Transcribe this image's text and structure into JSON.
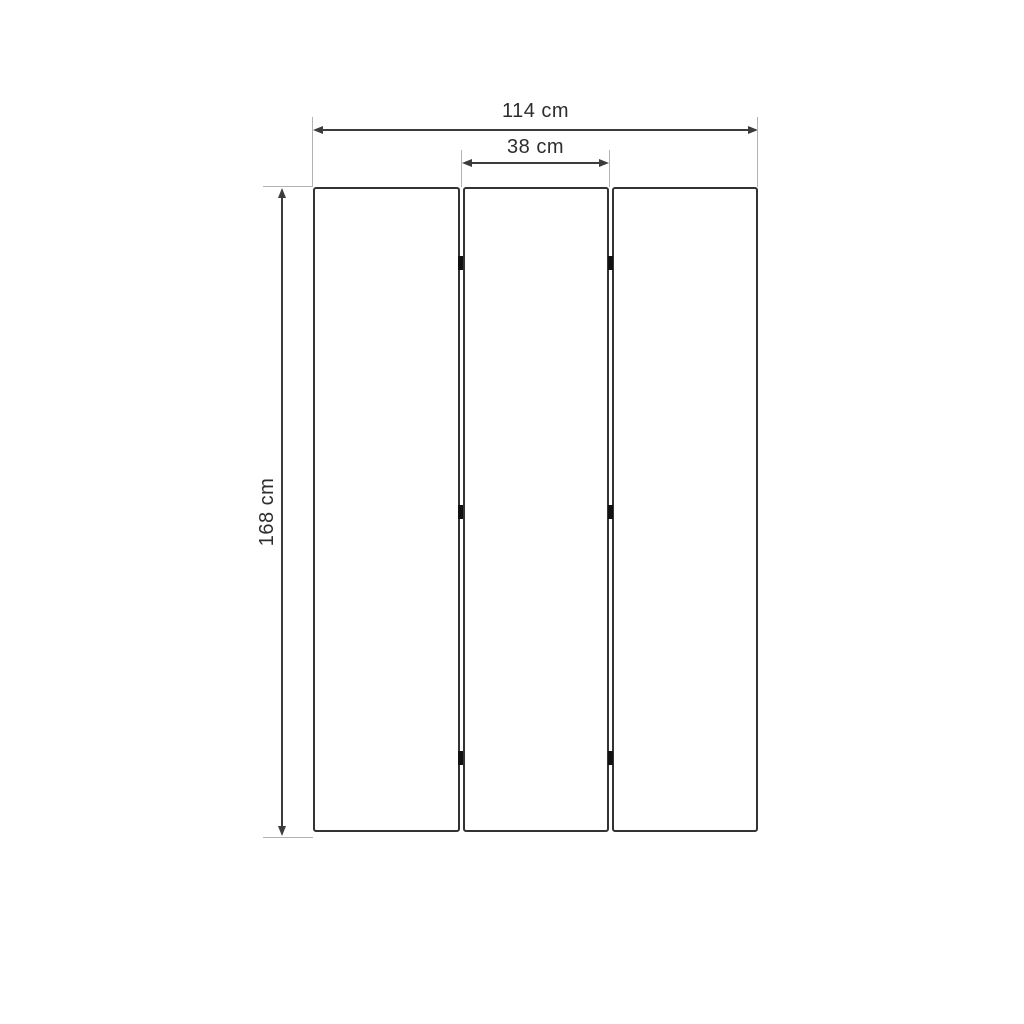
{
  "diagram": {
    "type": "technical-drawing",
    "panel_count": 3,
    "hinge_count": 6,
    "dimensions": {
      "total_width_label": "114 cm",
      "panel_width_label": "38 cm",
      "height_label": "168 cm"
    },
    "colors": {
      "background": "#ffffff",
      "panel_border": "#333333",
      "dimension_line": "#3c3c3c",
      "extension_line": "#b3b3b3",
      "hinge": "#111111",
      "label_text": "#2d2d2d"
    }
  }
}
